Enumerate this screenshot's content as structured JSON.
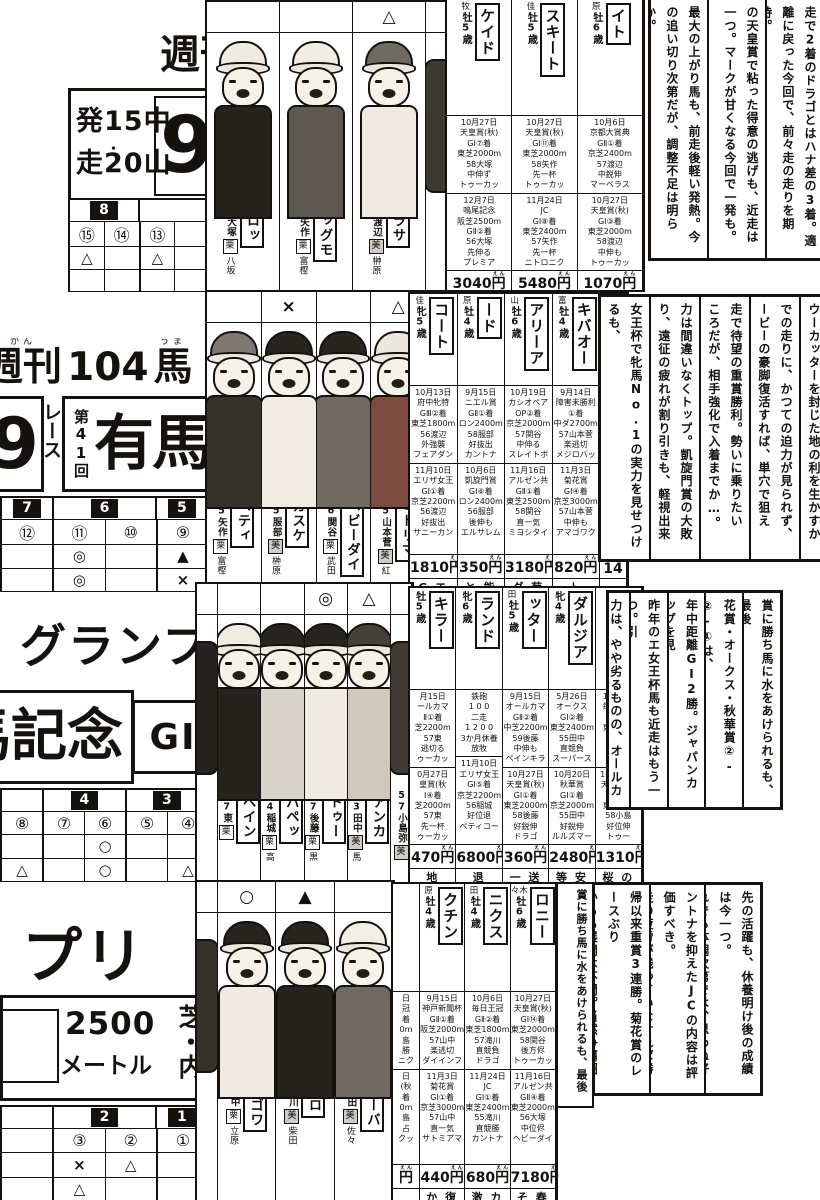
{
  "page": {
    "ink": "#15120e",
    "paper": "#ffffff",
    "yen_furigana": "えん"
  },
  "band1": {
    "week": {
      "text": "週刊",
      "furigana": "しゅう"
    },
    "info": {
      "line1": "発15中",
      "line2": "走20山",
      "dot": "・",
      "race_number": "9"
    },
    "grid": {
      "groups": [
        {
          "label": "8",
          "numbers": [
            "⑮",
            "⑭"
          ]
        },
        {
          "label": "",
          "numbers": [
            "⑬",
            ""
          ]
        }
      ],
      "rows": [
        [
          "△",
          "",
          "△",
          ""
        ],
        [
          "",
          "",
          "",
          ""
        ]
      ]
    },
    "jockeys": [
      {
        "mark": "",
        "horse": "ブロッ",
        "jockey": "57大塚",
        "stable": "栗",
        "trainer": "八坂",
        "cap": "#efebe1",
        "shirt": "#26221d"
      },
      {
        "mark": "",
        "horse": "ビッグモ",
        "jockey": "57矢作",
        "stable": "栗",
        "trainer": "富樫",
        "cap": "#f1ede3",
        "shirt": "#5d5952"
      },
      {
        "mark": "△",
        "horse": "パラサ",
        "jockey": "56渡辺",
        "stable": "美",
        "trainer": "榊原",
        "cap": "#6e6a62",
        "shirt": "#efebe1"
      },
      {
        "cut": true,
        "cap": "#26221d",
        "shirt": "#3c3832"
      }
    ],
    "columns": [
      {
        "top": "牧",
        "age": "牡5歳",
        "name": "ケイド",
        "races": [
          "10月27日\n天皇賞(秋)\nGⅠ⑦着\n東芝2000m\n58大塚\n中伸ず\nトゥーカッ",
          "12月7日\n鳴尾記念\n阪芝2500m\nGⅡ②着\n56大塚\n先伸る\nプレミア"
        ],
        "odds": "3040円",
        "next": "週 夏"
      },
      {
        "top": "佳",
        "age": "牡5歳",
        "name": "スキート",
        "races": [
          "10月27日\n天皇賞(秋)\nGⅠ⑪着\n東芝2000m\n58矢作\n先一杯\nトゥーカッ",
          "11月24日\nJC\nGⅠ⑧着\n東芝2400m\n57矢作\n先一杯\nニトロニク"
        ],
        "odds": "5480円",
        "next": "今 春"
      },
      {
        "top": "原",
        "age": "牡6歳",
        "name": "イト",
        "races": [
          "10月6日\n京都大賞典\nGⅡ①着\n京芝2400m\n57渡辺\n中鋭伸\nマーベラス",
          "10月27日\n天皇賞(秋)\nGⅠ③着\n東芝2000m\n58渡辺\n中伸も\nトゥーカッ"
        ],
        "odds": "1070円",
        "next": "距 前"
      }
    ],
    "comments": [
      [
        "走で2着のドラゴとはハナ差の3着。適",
        "離に戻った今回で、前々走の走りを期待。"
      ],
      [
        "の天皇賞で粘った得意の逃げも、近走は",
        "一つ。マークが甘くなる今回で一発も。"
      ],
      [
        "最大の上がり馬も、前走後軽い発熱。今",
        "の追い切り次第だが、調整不足は明らか。"
      ]
    ]
  },
  "band2": {
    "magazine": {
      "p1": "週刊",
      "f1": "かん",
      "p2": "104",
      "p3": "馬",
      "f3": "うま"
    },
    "title": {
      "nine": "9",
      "race_word": "レース",
      "edition": "第41回",
      "name": "有馬"
    },
    "grid": {
      "groups": [
        {
          "label": "7",
          "numbers": [
            "⑫"
          ]
        },
        {
          "label": "6",
          "numbers": [
            "⑪",
            "⑩"
          ]
        },
        {
          "label": "5",
          "numbers": [
            "⑨"
          ]
        }
      ],
      "rows": [
        [
          "",
          "◎",
          "",
          "▲"
        ],
        [
          "",
          "◎",
          "",
          "×"
        ]
      ]
    },
    "jockeys": [
      {
        "mark": "",
        "horse": "ペティ",
        "jockey": "55矢作",
        "stable": "栗",
        "trainer": "富樫",
        "cap": "#7d7971",
        "shirt": "#35312b"
      },
      {
        "mark": "×",
        "horse": "カスケ",
        "jockey": "55服部",
        "stable": "美",
        "trainer": "榊原",
        "cap": "#28241f",
        "shirt": "#f0ece2"
      },
      {
        "mark": "",
        "horse": "ヘビーダイ",
        "jockey": "56関谷",
        "stable": "栗",
        "trainer": "武田",
        "cap": "#28241f",
        "shirt": "#6f6a62"
      },
      {
        "mark": "△",
        "horse": "ミドリマ",
        "jockey": "55山本菅",
        "stable": "美",
        "trainer": "紅",
        "cap": "#ece8de",
        "shirt": "#7d4a41"
      },
      {
        "cut": true,
        "cap": "#28241f",
        "shirt": "#44403a"
      }
    ],
    "columns": [
      {
        "top": "佳",
        "age": "牝5歳",
        "name": "コート",
        "races": [
          "10月13日\n府中牝特\nGⅢ②着\n東芝1800m\n56渡辺\n外強襲\nフェアダン",
          "11月10日\nエリザ女王\nGⅠ①着\n京芝2200m\n56渡辺\n好抜出\nサニーカン"
        ],
        "odds": "1810円",
        "next": "G エ"
      },
      {
        "top": "原",
        "age": "牡4歳",
        "name": "ード",
        "races": [
          "9月15日\nニエル賞\nGⅡ①着\nロン2400m\n58服部\n好抜出\nカントナ",
          "10月6日\n凱旋門賞\nGⅠ⑥着\nロン2400m\n56服部\n後伸も\nエルサレム"
        ],
        "odds": "350円",
        "next": "と 能"
      },
      {
        "top": "山",
        "age": "牡6歳",
        "name": "アリーア",
        "races": [
          "10月19日\nカシオペア\nOP②着\n京芝2000m\n57関谷\n中伸る\nスレイトボ",
          "11月16日\nアルゼン共\nGⅡ①着\n東芝2500m\n58関谷\n直一気\nミヨシタイ"
        ],
        "odds": "3180円",
        "next": "ダ 菊"
      },
      {
        "top": "富",
        "age": "牡4歳",
        "name": "キバオー",
        "races": [
          "9月14日\n障害未勝利\n①着\n中ダ2700m\n57山本菅\n楽逃切\nメジロバッ",
          "11月3日\n菊花賞\nGⅠ④着\n京芝3000m\n57山本菅\n中伸も\nアマゴワク"
        ],
        "odds": "820円",
        "next": "ト"
      },
      {
        "frag": true,
        "top": "",
        "age": "5歳",
        "name": "",
        "races": [
          "9月\nオー\nG\n中芝\nト",
          "10月\n天皇\nG\n東芝\nト"
        ],
        "odds": "14",
        "next": ""
      }
    ],
    "comments": [
      [
        "ウーカッターを封じた地の利を生かすか"
      ],
      [
        "での走りに、かつての迫力が見られず、",
        "ービーの豪脚復活すれば、単穴で狙える。"
      ],
      [
        "走で待望の重賞勝利。勢いに乗りたい",
        "ころだが、相手強化で入着までか…。"
      ],
      [
        "力は間違いなくトップ。凱旋門賞の大敗",
        "り、遠征の疲れが割り引きも、軽視出来ぬ。"
      ],
      [
        "女王杯で牝馬No.1の実力を見せつけるも、",
        "Iクラスの牡馬とは初対決。どこまで…"
      ]
    ]
  },
  "band3": {
    "title": {
      "grandprix": "グランプ",
      "kinen": "馬記念",
      "grade": "GⅠ"
    },
    "grid": {
      "groups": [
        {
          "label": "",
          "numbers": [
            "⑧"
          ]
        },
        {
          "label": "4",
          "numbers": [
            "⑦",
            "⑥"
          ]
        },
        {
          "label": "3",
          "numbers": [
            "⑤",
            "④"
          ]
        }
      ],
      "rows": [
        [
          "",
          "",
          "○",
          "",
          ""
        ],
        [
          "△",
          "",
          "○",
          "",
          "△"
        ]
      ]
    },
    "jockeys": [
      {
        "cut": true,
        "cap": "#ece8de",
        "shirt": "#26221d"
      },
      {
        "mark": "",
        "horse": "ペイン",
        "jockey": "57東",
        "stable": "栗",
        "trainer": "",
        "cap": "#f0ece2",
        "shirt": "#26221d"
      },
      {
        "mark": "",
        "horse": "パペッ",
        "jockey": "54稲城",
        "stable": "栗",
        "trainer": "高",
        "cap": "#28241f",
        "shirt": "#d9d4c9"
      },
      {
        "mark": "◎",
        "horse": "トゥー",
        "jockey": "57後藤",
        "stable": "栗",
        "trainer": "黒",
        "cap": "#28241f",
        "shirt": "#efebe1"
      },
      {
        "mark": "△",
        "horse": "アンカ",
        "jockey": "53田中",
        "stable": "美",
        "trainer": "馬",
        "cap": "#45413a",
        "shirt": "#cfc9bc"
      },
      {
        "cut": true,
        "horse": "",
        "jockey": "57小島弥",
        "stable": "美",
        "trainer": "",
        "cap": "#28241f",
        "shirt": "#3f3b34"
      }
    ],
    "columns": [
      {
        "top": "",
        "age": "牡5歳",
        "name": "キラー",
        "races": [
          "月15日\nールカマ\nⅡ①着\n芝2200m\n57東\n逃切る\nゥーカッ",
          "0月27日\n皇賞(秋\nⅠ④着\n芝2000m\n57東\n先一杯\nゥーカッ"
        ],
        "odds": "470円",
        "next": "地"
      },
      {
        "top": "",
        "age": "牝6歳",
        "name": "ランド",
        "races": [
          "鉄砲\n1 0 0\n二走\n1 2 0 0\n3か月休養\n放牧",
          "11月10日\nエリザ女王\nGⅠ⑤着\n京芝2200m\n56稲城\n好位退\nペティコー"
        ],
        "odds": "6800円",
        "next": "退"
      },
      {
        "top": "田",
        "age": "牡5歳",
        "name": "ッター",
        "races": [
          "9月15日\nオールカマ\nGⅡ②着\n中芝2200m\n59後藤\n中伸も\nペインキラ",
          "10月27日\n天皇賞(秋)\nGⅠ①着\n東芝2000m\n58後藤\n好鋭伸\nドラゴ"
        ],
        "odds": "360円",
        "next": "一 送"
      },
      {
        "top": "",
        "age": "牝4歳",
        "name": "ダルジア",
        "races": [
          "5月26日\nオークス\nGⅠ②着\n東芝2400m\n55田中\n直競負\nスーパース",
          "10月20日\n秋華賞\nGⅠ①着\n京芝2000m\n55田中\n好鋭伸\nルルズマー"
        ],
        "odds": "2480円",
        "next": "等 安"
      },
      {
        "top": "江",
        "age": "牡5歳",
        "name": "",
        "races": [
          "10月6日\n毎日王冠\nGⅡ①着\n東芝180\n57小島\n直競負\nニトロ",
          "10月27日\n天皇賞(秋\nGⅠ②着\n東芝200\n58小島\n好位伸\nトゥー"
        ],
        "odds": "1310円",
        "next": "桜 の"
      }
    ],
    "comments": [
      [
        "賞に勝ち馬に水をあけられるも、最後",
        "直線の伸び脚は見所有り。見限れない。"
      ],
      [
        "花賞・オークス・秋華賞②-②-①は、",
        "定感があるも、相手が牡馬一線級では…。"
      ],
      [
        "年中距離GⅠ2勝。ジャパンカップを見",
        "り、体調は前走以上。優勝候補の一頭。"
      ],
      [
        "昨年のエ女王杯馬も近走はもう一つ。引",
        "レースの今回で、奇跡を起こせるか…。"
      ],
      [
        "力は、やや劣るものの、オールカマーで"
      ]
    ]
  },
  "band4": {
    "title": {
      "puri": "プリ",
      "distance": "2500",
      "unit": "メートル",
      "course": "芝・内"
    },
    "grid": {
      "groups": [
        {
          "label": "",
          "numbers": [
            ""
          ]
        },
        {
          "label": "2",
          "numbers": [
            "③",
            "②"
          ]
        },
        {
          "label": "1",
          "numbers": [
            "①"
          ]
        }
      ],
      "rows": [
        [
          "",
          "×",
          "△",
          ""
        ],
        [
          "",
          "△",
          "",
          ""
        ]
      ]
    },
    "jockeys": [
      {
        "cut": true,
        "cap": "#28241f",
        "shirt": "#35312b"
      },
      {
        "mark": "○",
        "horse": "アマゴワ",
        "jockey": "55山中",
        "stable": "栗",
        "trainer": "立原",
        "cap": "#28241f",
        "shirt": "#efebe1"
      },
      {
        "mark": "▲",
        "horse": "ニトロ",
        "jockey": "55滝川",
        "stable": "美",
        "trainer": "柴田",
        "cap": "#28241f",
        "shirt": "#26221d"
      },
      {
        "mark": "",
        "horse": "ビリーバ",
        "jockey": "56増田",
        "stable": "美",
        "trainer": "佐々",
        "cap": "#f2eee4",
        "shirt": "#6e6961"
      }
    ],
    "columns": [
      {
        "frag": true,
        "top": "",
        "age": "",
        "name": "",
        "races": [
          "日\n冠\n着\n0m\n島\n勝\nニク",
          "日\n(秋\n着\n0m\n島\n占\nクッ"
        ],
        "odds": "円",
        "next": ""
      },
      {
        "top": "原",
        "age": "牡4歳",
        "name": "クチン",
        "races": [
          "9月15日\n神戸新聞杯\nGⅡ①着\n阪芝2000m\n57山中\n楽逃切\nダイインフ",
          "11月3日\n菊花賞\nGⅠ①着\n京芝3000m\n57山中\n直一気\nサトミアマ"
        ],
        "odds": "440円",
        "next": "か 復"
      },
      {
        "top": "田",
        "age": "牡4歳",
        "name": "ニクス",
        "races": [
          "10月6日\n毎日王冠\nGⅡ②着\n東芝1800m\n57滝川\n直競負\nドラゴ",
          "11月24日\nJC\nGⅠ①着\n東芝2400m\n55滝川\n直競勝\nカントナ"
        ],
        "odds": "680円",
        "next": "激 カ"
      },
      {
        "top": "々木",
        "age": "牡6歳",
        "name": "ロニー",
        "races": [
          "10月27日\n天皇賞(秋)\nGⅠ⑭着\n東芝2000m\n58関谷\n後方侭\nトゥーカッ",
          "11月16日\nアルゼン共\nGⅡ④着\n東芝2000m\n56大塚\n中位侭\nヘビーダイ"
        ],
        "odds": "7180円",
        "next": "そ 春"
      }
    ],
    "frag_column": "賞に勝ち馬に水をあけられるも、最後",
    "comments": [
      [
        "先の活躍も、休養明け後の成績は今一つ。",
        "れでも体調次第では、思わぬ好走も…。"
      ],
      [
        "ントナを抑えたJCの内容は評価すべき。",
        "走の疲労が残っていなければ勝機は十分。"
      ],
      [
        "帰以来重賞3連勝。菊花賞のレースぶり",
        "からも展開は不問。当然争覇圏内だろう。"
      ]
    ]
  }
}
